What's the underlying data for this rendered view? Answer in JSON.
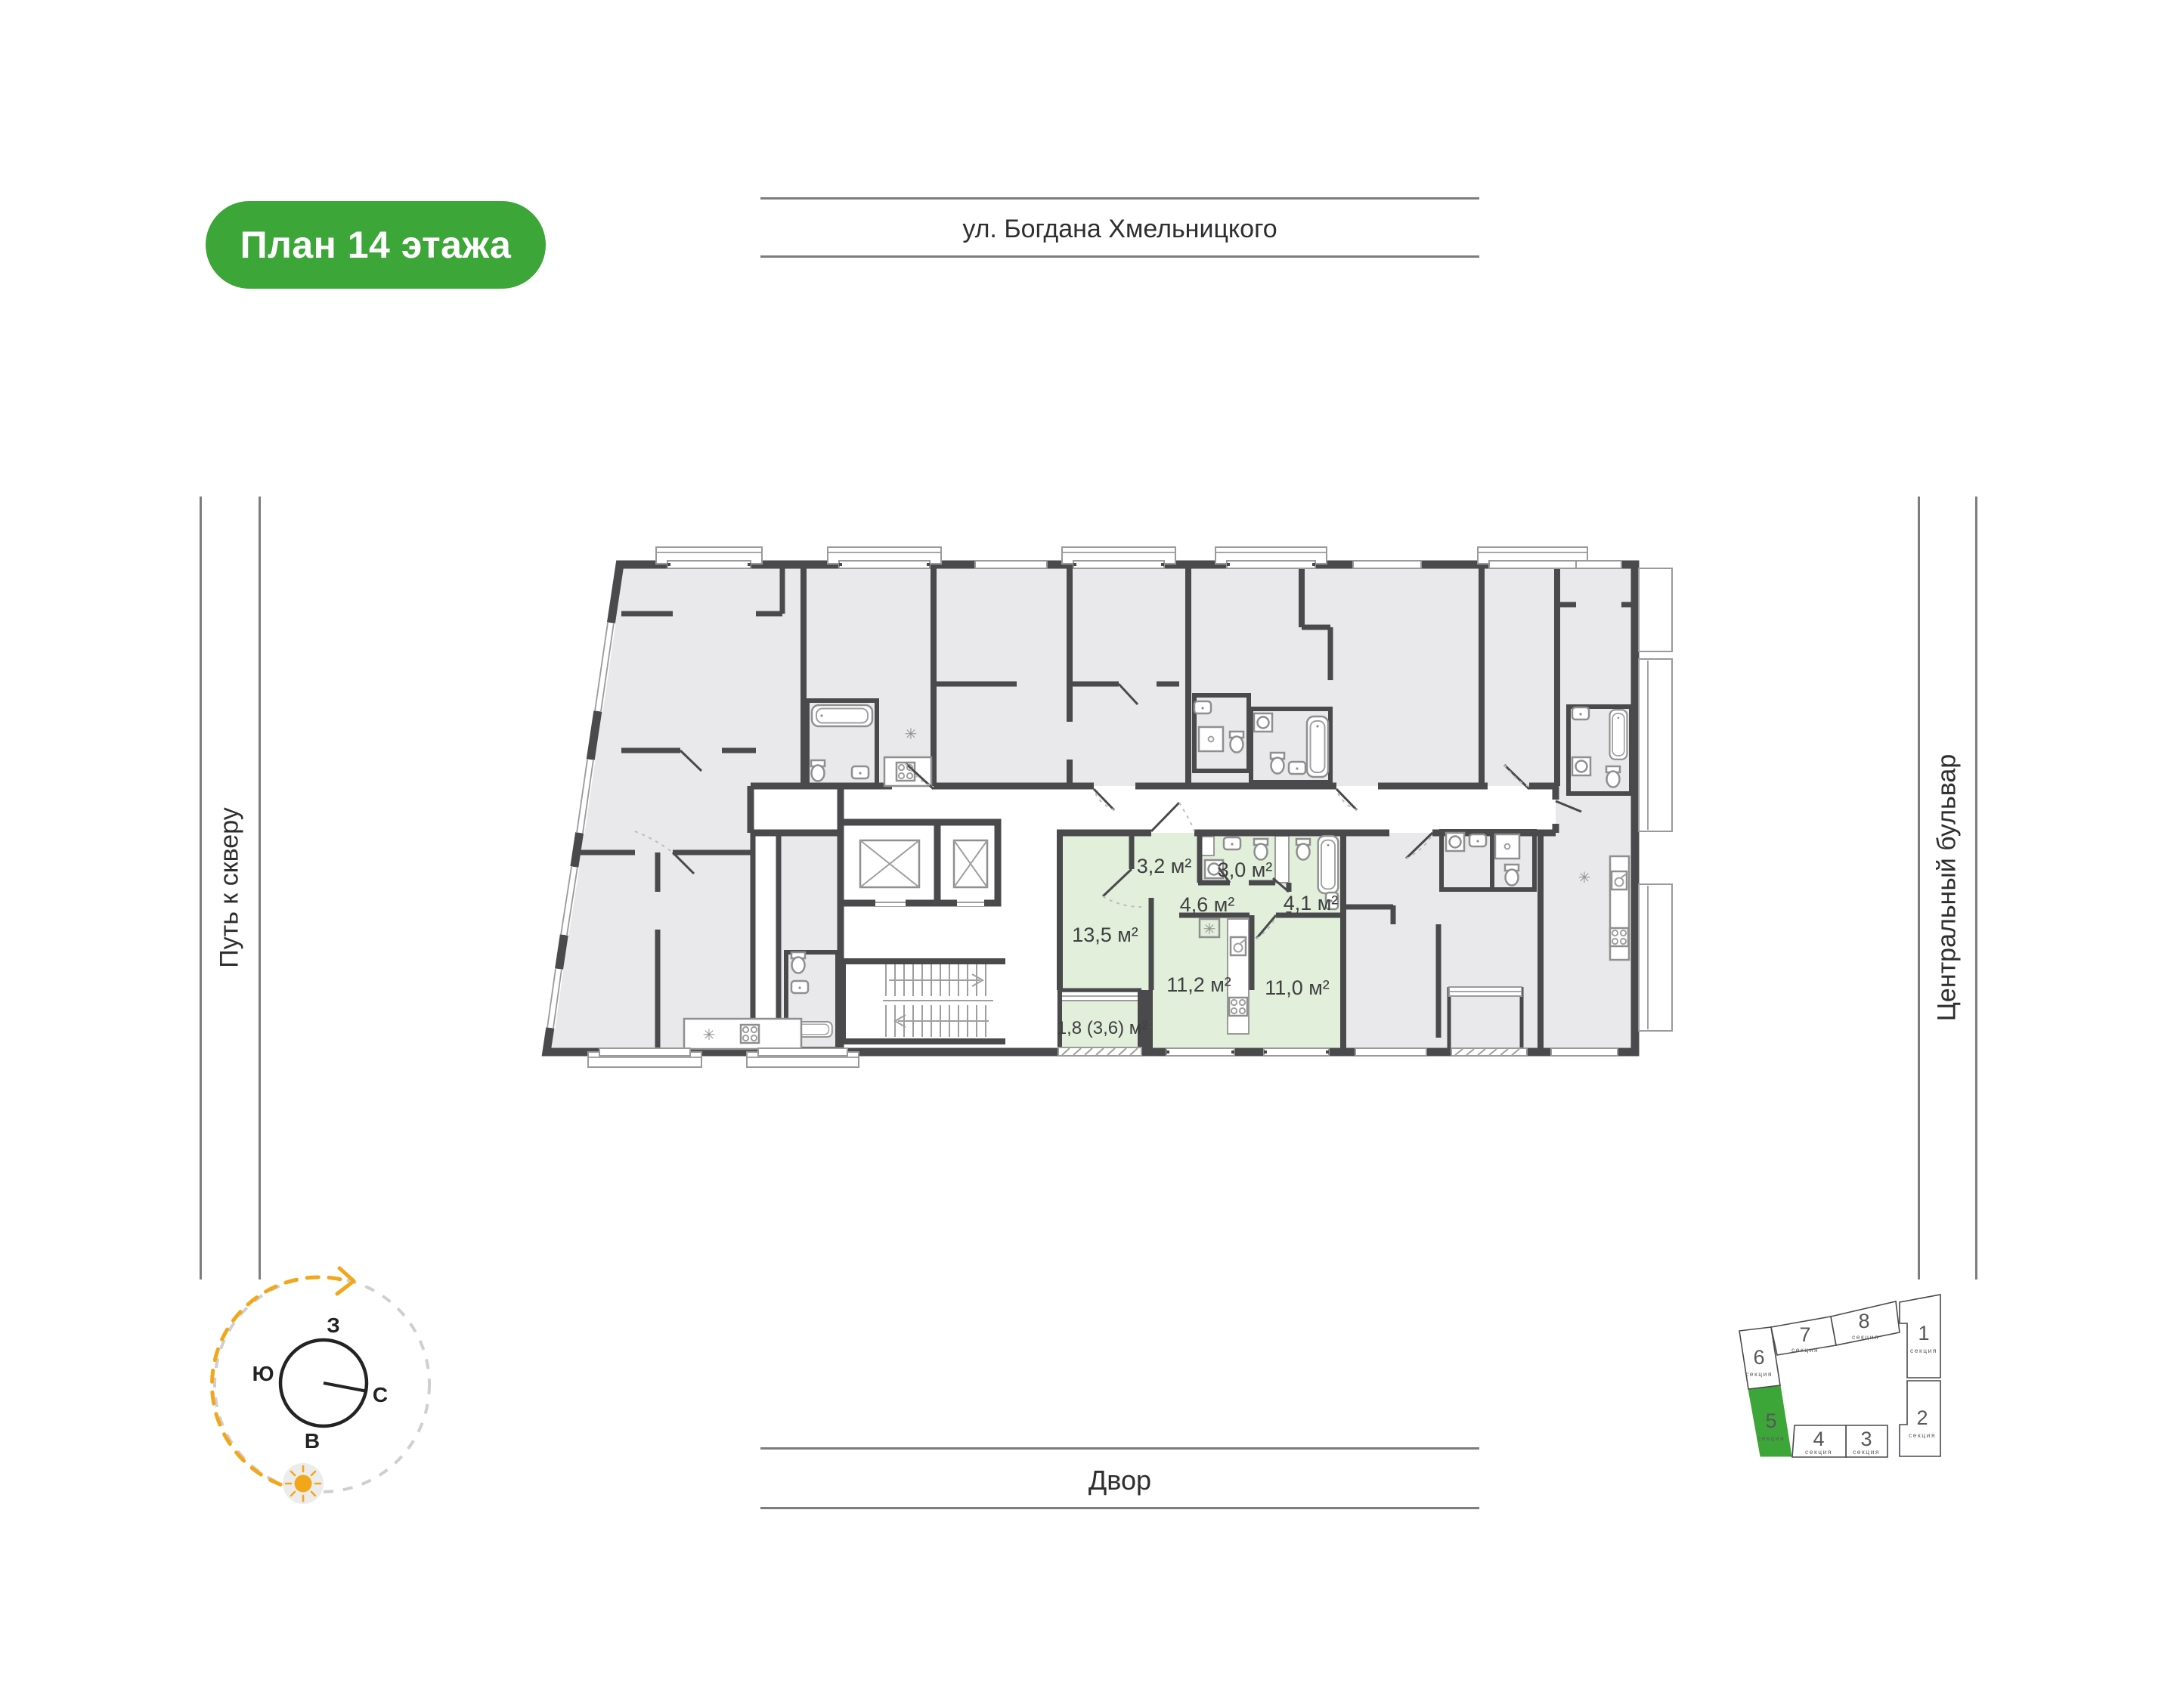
{
  "badge": {
    "label": "План 14 этажа",
    "bg_color": "#3DA639",
    "text_color": "#ffffff"
  },
  "surroundings": {
    "top_street": "ул. Богдана Хмельницкого",
    "bottom_area": "Двор",
    "left_path": "Путь к скверу",
    "right_boulevard": "Центральный бульвар"
  },
  "compass": {
    "west": "З",
    "south": "Ю",
    "north": "С",
    "east": "В",
    "arc_color": "#F2A71B",
    "inactive_arc_color": "#cfcfcf"
  },
  "floor_plan": {
    "highlight_color": "#E2EFDB",
    "wall_color": "#4A4A4D",
    "room_fill_color": "#E9E9EB",
    "rooms": [
      {
        "name": "hallway",
        "area": "3,2 м²"
      },
      {
        "name": "bathroom",
        "area": "3,0 м²"
      },
      {
        "name": "hall",
        "area": "4,6 м²"
      },
      {
        "name": "bathroom-2",
        "area": "4,1 м²"
      },
      {
        "name": "living-room",
        "area": "13,5 м²"
      },
      {
        "name": "kitchen",
        "area": "11,2 м²"
      },
      {
        "name": "bedroom",
        "area": "11,0 м²"
      },
      {
        "name": "balcony",
        "area": "1,8 (3,6) м²"
      }
    ]
  },
  "key_plan": {
    "selected": "5",
    "sections": [
      {
        "number": "1",
        "label": "секция"
      },
      {
        "number": "2",
        "label": "секция"
      },
      {
        "number": "3",
        "label": "секция"
      },
      {
        "number": "4",
        "label": "секция"
      },
      {
        "number": "5",
        "label": "секция"
      },
      {
        "number": "6",
        "label": "секция"
      },
      {
        "number": "7",
        "label": "секция"
      },
      {
        "number": "8",
        "label": "секция"
      }
    ]
  }
}
